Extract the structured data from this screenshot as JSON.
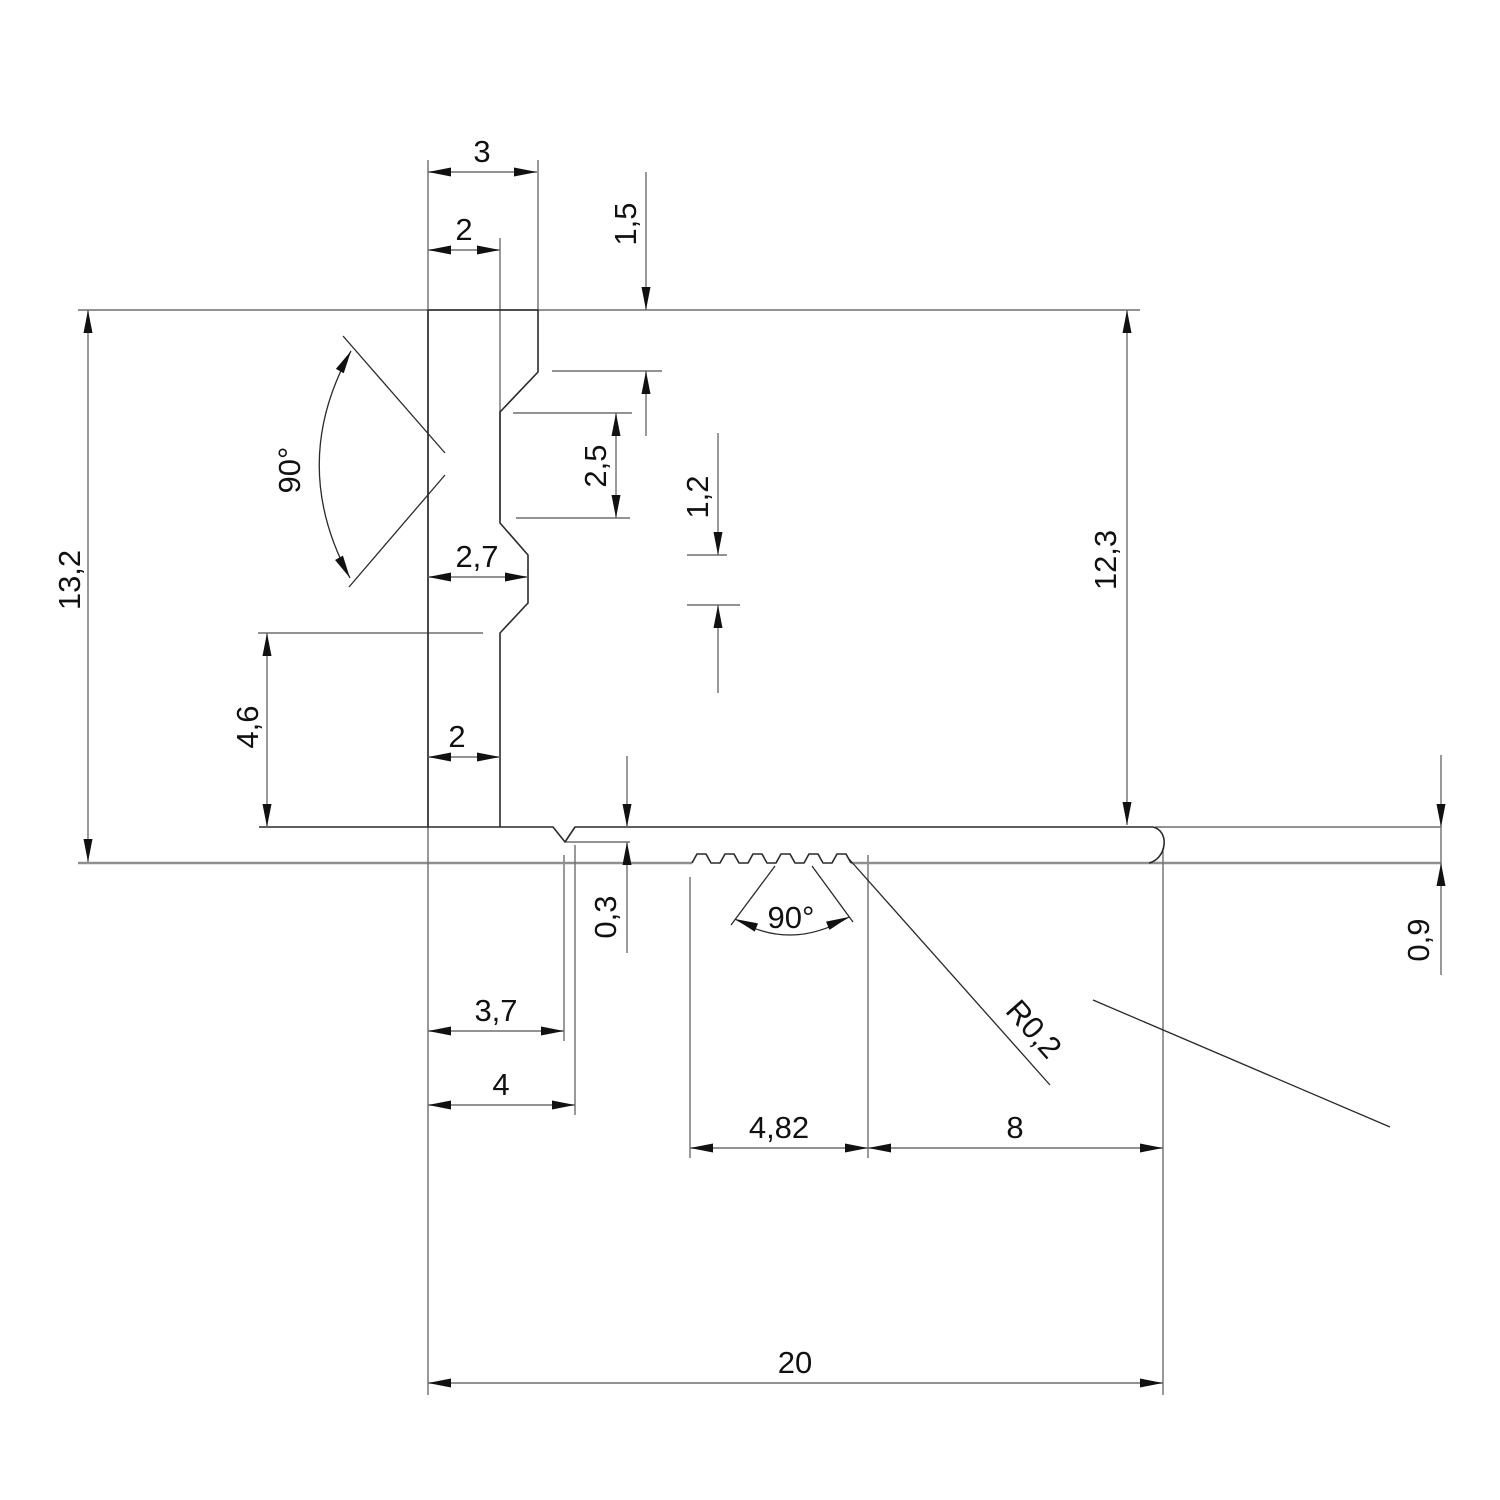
{
  "drawing": {
    "type": "technical-drawing",
    "subject": "extruded profile cross-section with dimensions"
  },
  "colors": {
    "background": "#ffffff",
    "outline": "#2a2a2a",
    "dimension": "#6e6e6e",
    "reference": "#8f8f8f",
    "text": "#111111"
  },
  "labels": {
    "w3": "3",
    "w2_top": "2",
    "h1_5": "1,5",
    "h2_5": "2,5",
    "h1_2": "1,2",
    "w2_7": "2,7",
    "angle_wall": "90°",
    "h13_2": "13,2",
    "h4_6": "4,6",
    "w2_bottom": "2",
    "h12_3": "12,3",
    "h0_3": "0,3",
    "w3_7": "3,7",
    "w4": "4",
    "angle_ribs": "90°",
    "radius": "R0,2",
    "w4_82": "4,82",
    "w8": "8",
    "w20": "20",
    "h0_9": "0,9"
  }
}
